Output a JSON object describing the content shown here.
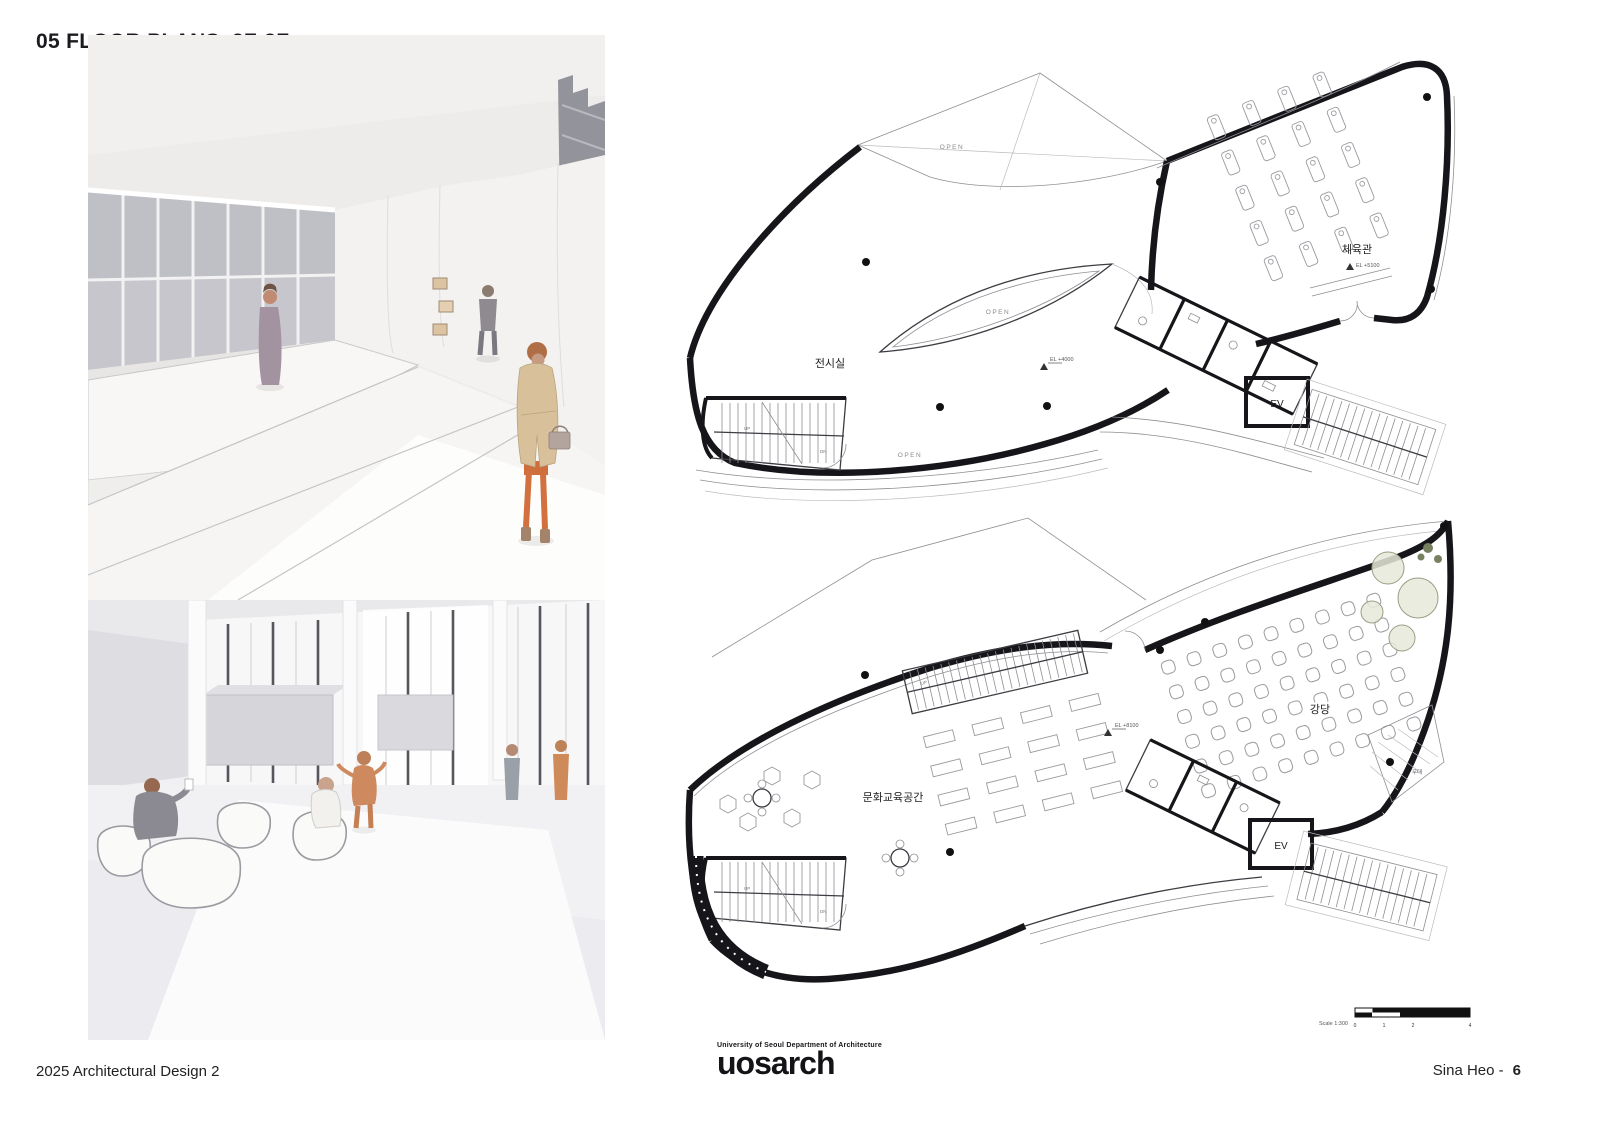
{
  "page": {
    "title": "05 FLOOR PLANS_2F-3F"
  },
  "plans": {
    "upper": {
      "labels": {
        "exhibition": "전시실",
        "gym": "체육관",
        "elevator": "EV"
      },
      "open_labels": [
        "OPEN",
        "OPEN",
        "OPEN"
      ],
      "elevation_markers": {
        "hall": "EL +4000",
        "gym": "EL +5100"
      },
      "stairs": {
        "up": "UP",
        "dn": "DN"
      }
    },
    "lower": {
      "labels": {
        "culture_edu": "문화교육공간",
        "auditorium": "강당",
        "stage": "무대",
        "elevator": "EV"
      },
      "elevation_markers": {
        "hall": "EL +8100"
      },
      "stairs": {
        "up": "UP",
        "dn": "DN"
      }
    },
    "scale_bar": {
      "label": "Scale 1:300",
      "ticks": [
        "0",
        "1",
        "2",
        "4"
      ]
    }
  },
  "footer": {
    "course": "2025 Architectural Design 2",
    "logo_tagline": "University of Seoul Department of Architecture",
    "logo_text": "uosarch",
    "author": "Sina Heo -",
    "page_number": "6"
  },
  "colors": {
    "ink": "#16161a",
    "paper": "#ffffff",
    "coat_tan": "#d8c19a",
    "accent_orange": "#ce6e3c"
  }
}
